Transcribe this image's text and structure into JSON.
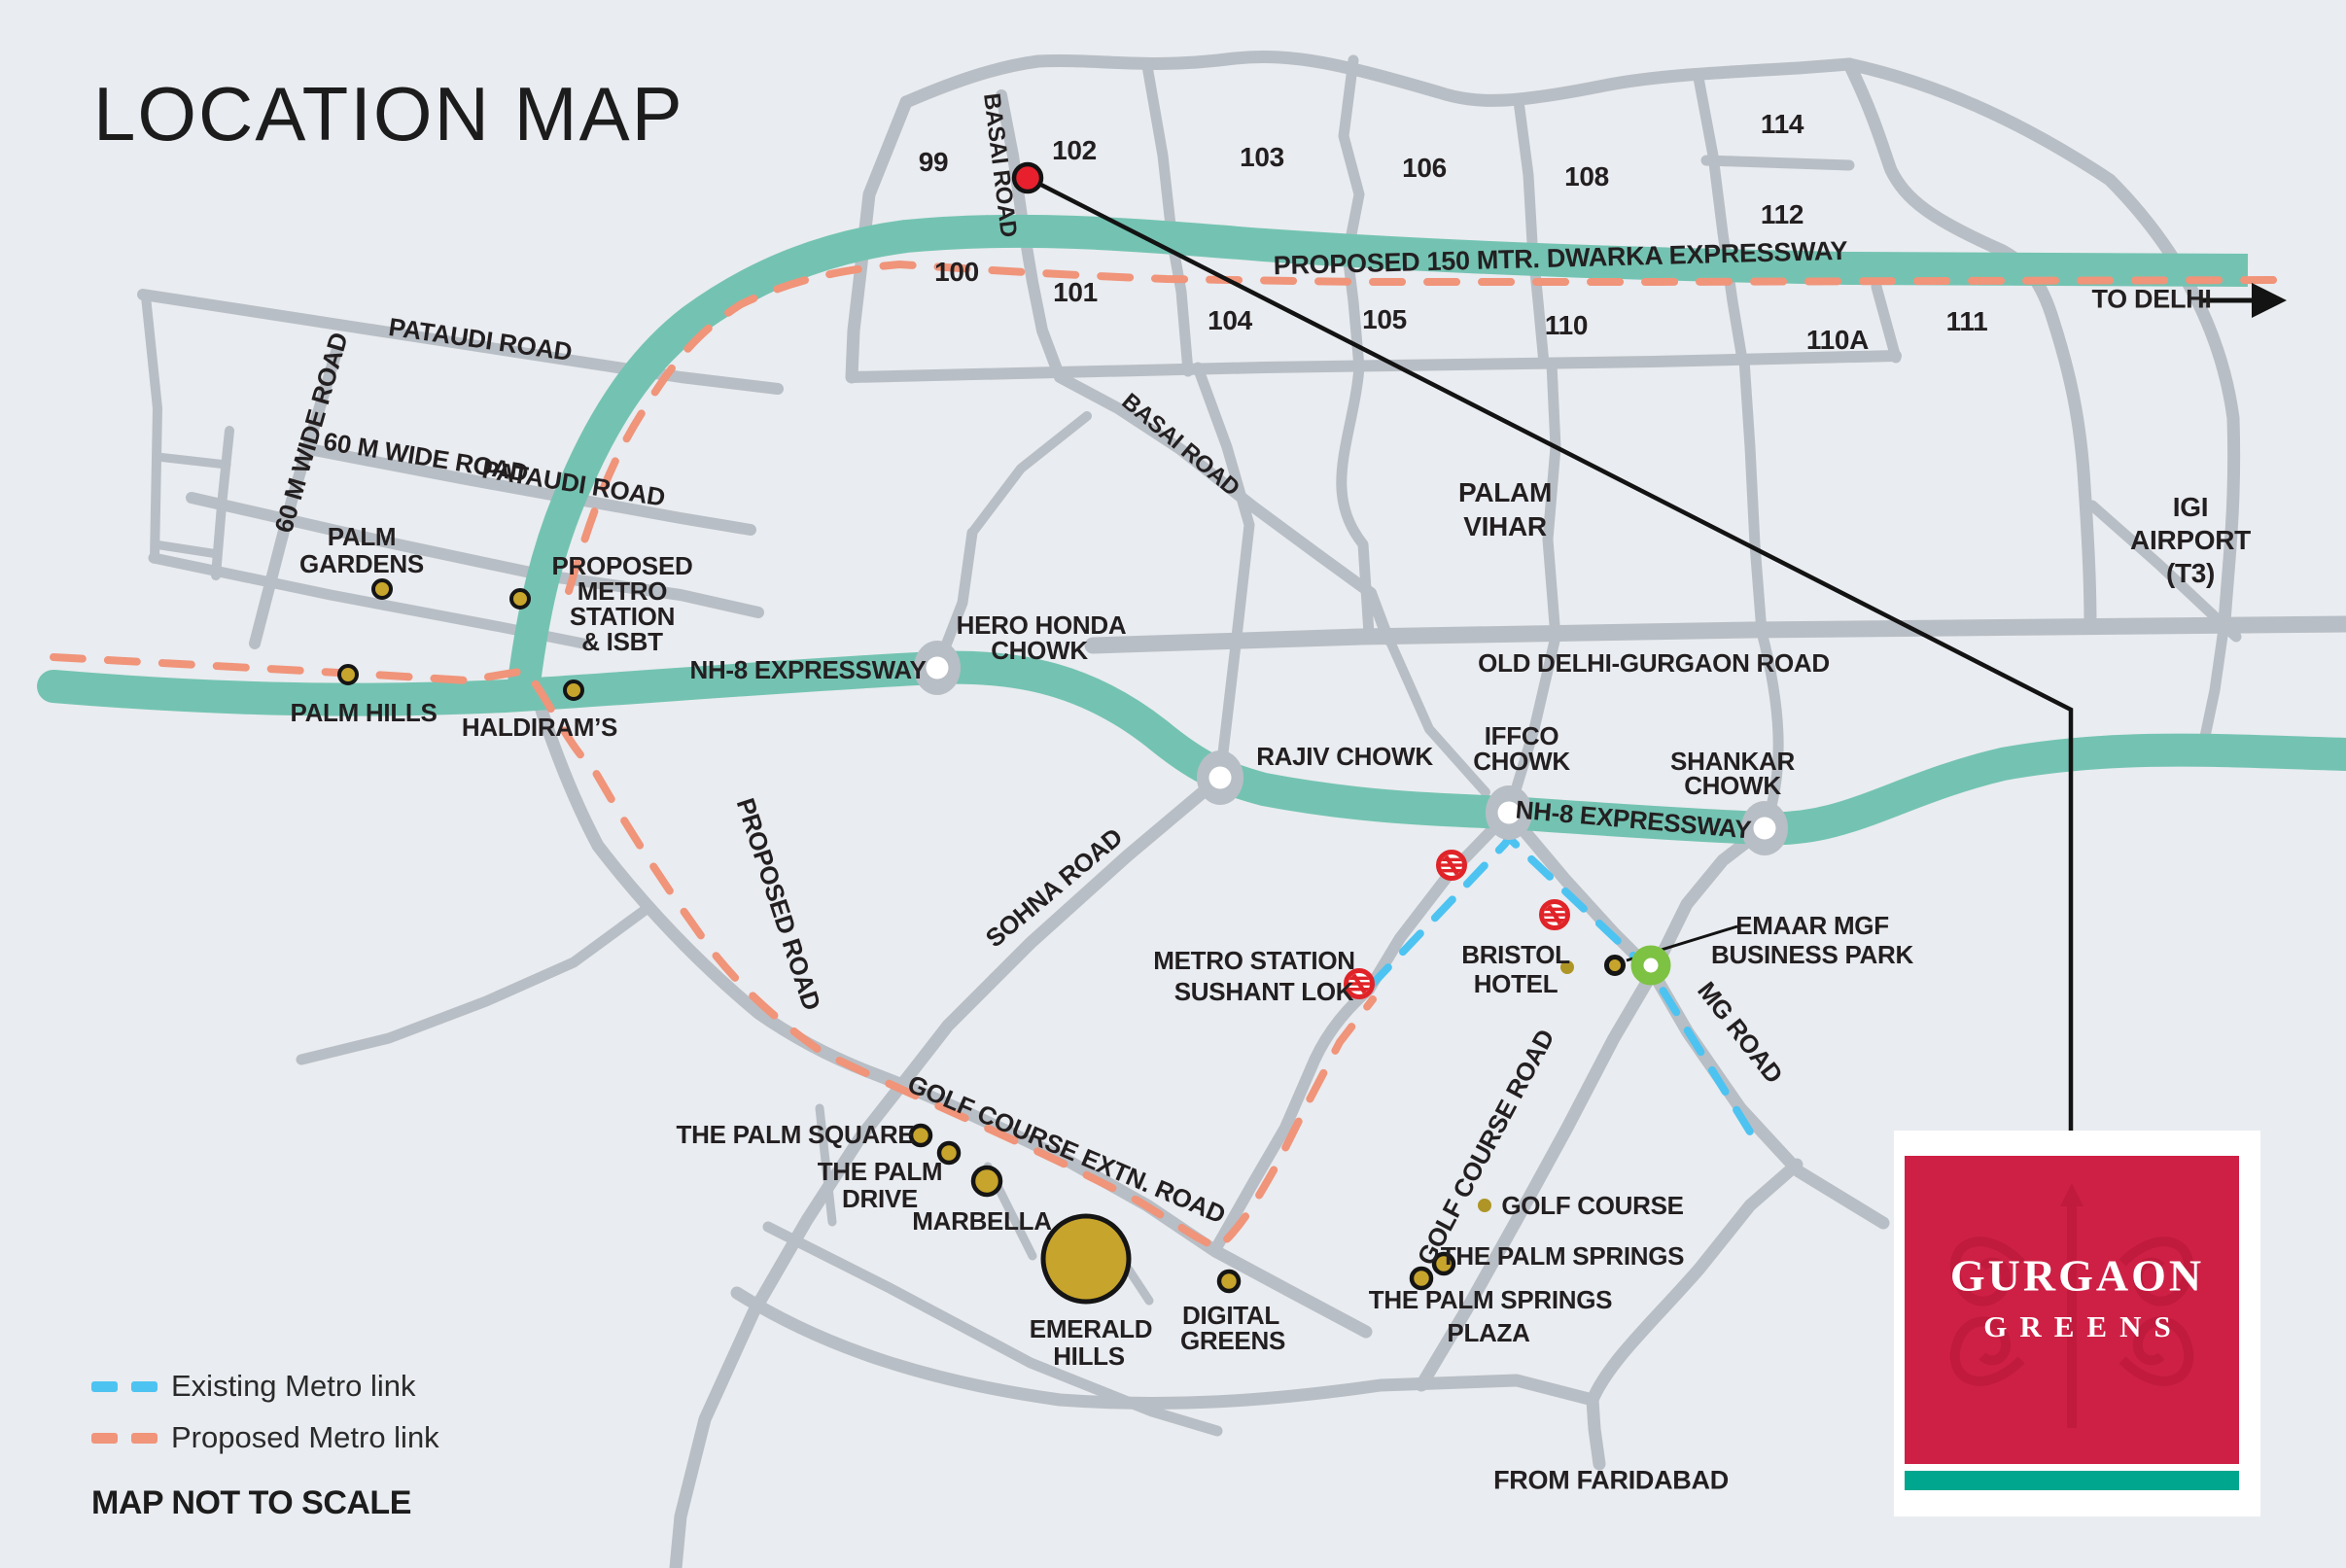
{
  "title": "LOCATION MAP",
  "sectors": {
    "s99": "99",
    "s100": "100",
    "s101": "101",
    "s102": "102",
    "s103": "103",
    "s104": "104",
    "s105": "105",
    "s106": "106",
    "s108": "108",
    "s110": "110",
    "s110a": "110A",
    "s111": "111",
    "s112": "112",
    "s114": "114"
  },
  "roads": {
    "pataudi_road_1": "PATAUDI ROAD",
    "pataudi_road_2": "PATAUDI ROAD",
    "wide_road_v": "60 M WIDE ROAD",
    "wide_road_h": "60 M WIDE ROAD",
    "basai_road_v": "BASAI ROAD",
    "basai_road_diag": "BASAI ROAD",
    "dwarka": "PROPOSED 150 MTR. DWARKA EXPRESSWAY",
    "nh8_west": "NH-8 EXPRESSWAY",
    "nh8_east": "NH-8 EXPRESSWAY",
    "old_delhi_gurgaon": "OLD DELHI-GURGAON ROAD",
    "sohna": "SOHNA ROAD",
    "proposed_road": "PROPOSED ROAD",
    "golf_course_extn": "GOLF COURSE EXTN. ROAD",
    "golf_course_road": "GOLF COURSE ROAD",
    "mg_road": "MG ROAD"
  },
  "directions": {
    "to_delhi": "TO DELHI",
    "from_faridabad": "FROM FARIDABAD"
  },
  "junctions": {
    "hero_honda_1": "HERO HONDA",
    "hero_honda_2": "CHOWK",
    "rajiv": "RAJIV CHOWK",
    "iffco_1": "IFFCO",
    "iffco_2": "CHOWK",
    "shankar_1": "SHANKAR",
    "shankar_2": "CHOWK"
  },
  "places": {
    "palm_gardens_1": "PALM",
    "palm_gardens_2": "GARDENS",
    "palm_hills": "PALM HILLS",
    "haldirams": "HALDIRAM’S",
    "metro_isbt_1": "PROPOSED",
    "metro_isbt_2": "METRO",
    "metro_isbt_3": "STATION",
    "metro_isbt_4": "& ISBT",
    "palam_vihar_1": "PALAM",
    "palam_vihar_2": "VIHAR",
    "igi_1": "IGI",
    "igi_2": "AIRPORT",
    "igi_3": "(T3)",
    "metro_sushant_1": "METRO STATION",
    "metro_sushant_2": "SUSHANT LOK",
    "bristol_1": "BRISTOL",
    "bristol_2": "HOTEL",
    "emaar_1": "EMAAR MGF",
    "emaar_2": "BUSINESS PARK",
    "palm_square": "THE PALM SQUARE",
    "palm_drive_1": "THE PALM",
    "palm_drive_2": "DRIVE",
    "marbella": "MARBELLA",
    "emerald_1": "EMERALD",
    "emerald_2": "HILLS",
    "digital_1": "DIGITAL",
    "digital_2": "GREENS",
    "golf_course": "GOLF COURSE",
    "palm_springs": "THE PALM SPRINGS",
    "springs_plaza_1": "THE PALM SPRINGS",
    "springs_plaza_2": "PLAZA"
  },
  "legend": {
    "existing": "Existing Metro link",
    "proposed": "Proposed Metro link",
    "note": "MAP NOT TO SCALE"
  },
  "logo": {
    "line1": "GURGAON",
    "line2": "GREENS"
  },
  "colors": {
    "background": "#e9ecf0",
    "road_gray": "#b8bec5",
    "expressway_teal": "#74c3b2",
    "existing_metro_blue": "#4dc3f1",
    "proposed_metro_orange": "#f0947a",
    "landmark_gold": "#c7a42c",
    "metro_logo_red": "#e02328",
    "site_marker_red": "#e8202d",
    "junction_green": "#7dc243",
    "brand_red": "#ce2045",
    "brand_teal": "#00a68e"
  }
}
